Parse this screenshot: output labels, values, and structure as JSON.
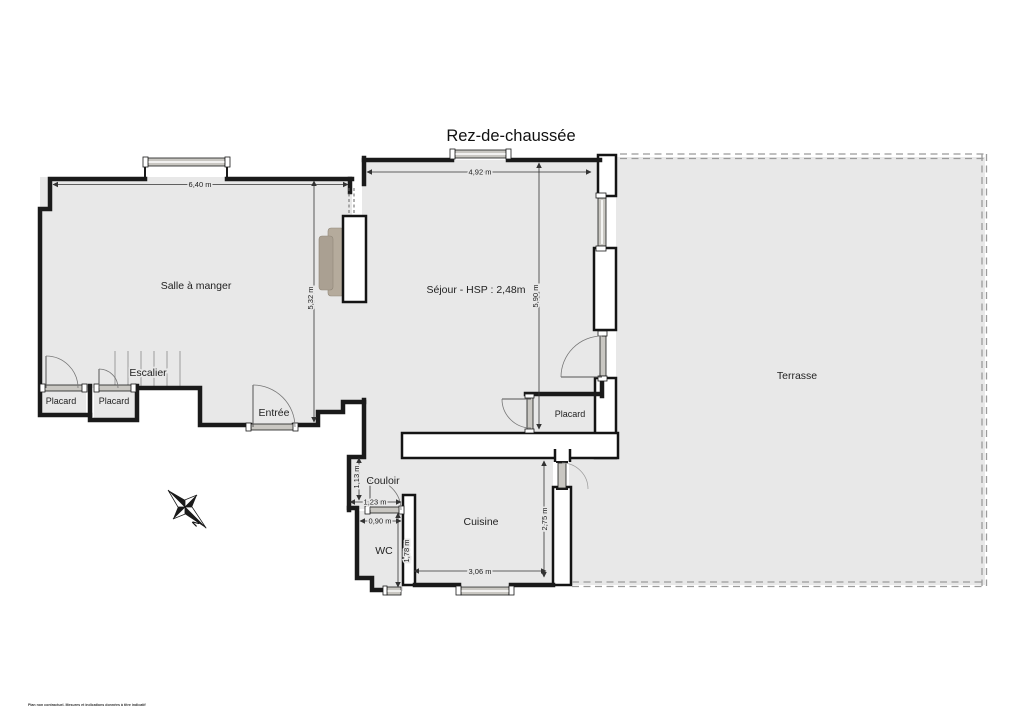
{
  "title": "Rez-de-chaussée",
  "rooms": {
    "salle_a_manger": "Salle à manger",
    "sejour": "Séjour - HSP : 2,48m",
    "terrasse": "Terrasse",
    "escalier": "Escalier",
    "placard_1": "Placard",
    "placard_2": "Placard",
    "placard_3": "Placard",
    "entree": "Entrée",
    "couloir": "Couloir",
    "wc": "WC",
    "cuisine": "Cuisine"
  },
  "dimensions": {
    "salle_a_manger_width": "6,40 m",
    "salle_a_manger_depth": "5,32 m",
    "sejour_width": "4,92 m",
    "sejour_depth": "5,90 m",
    "couloir_depth": "1,13 m",
    "couloir_width": "1,23 m",
    "wc_width": "0,90 m",
    "wc_depth": "1,78 m",
    "cuisine_width": "3,06 m",
    "cuisine_depth": "2,75 m"
  },
  "compass": {
    "north_label": "N"
  },
  "footer": {
    "disclaimer": "Plan non contractuel. Mesures et indications données à titre indicatif"
  },
  "colors": {
    "wall": "#1a1a1a",
    "floor": "#e8e8e8",
    "glazing": "#c9c7c2",
    "fireplace": "#b3a897",
    "terrace_dash": "#9b9b9b",
    "background": "#ffffff"
  }
}
